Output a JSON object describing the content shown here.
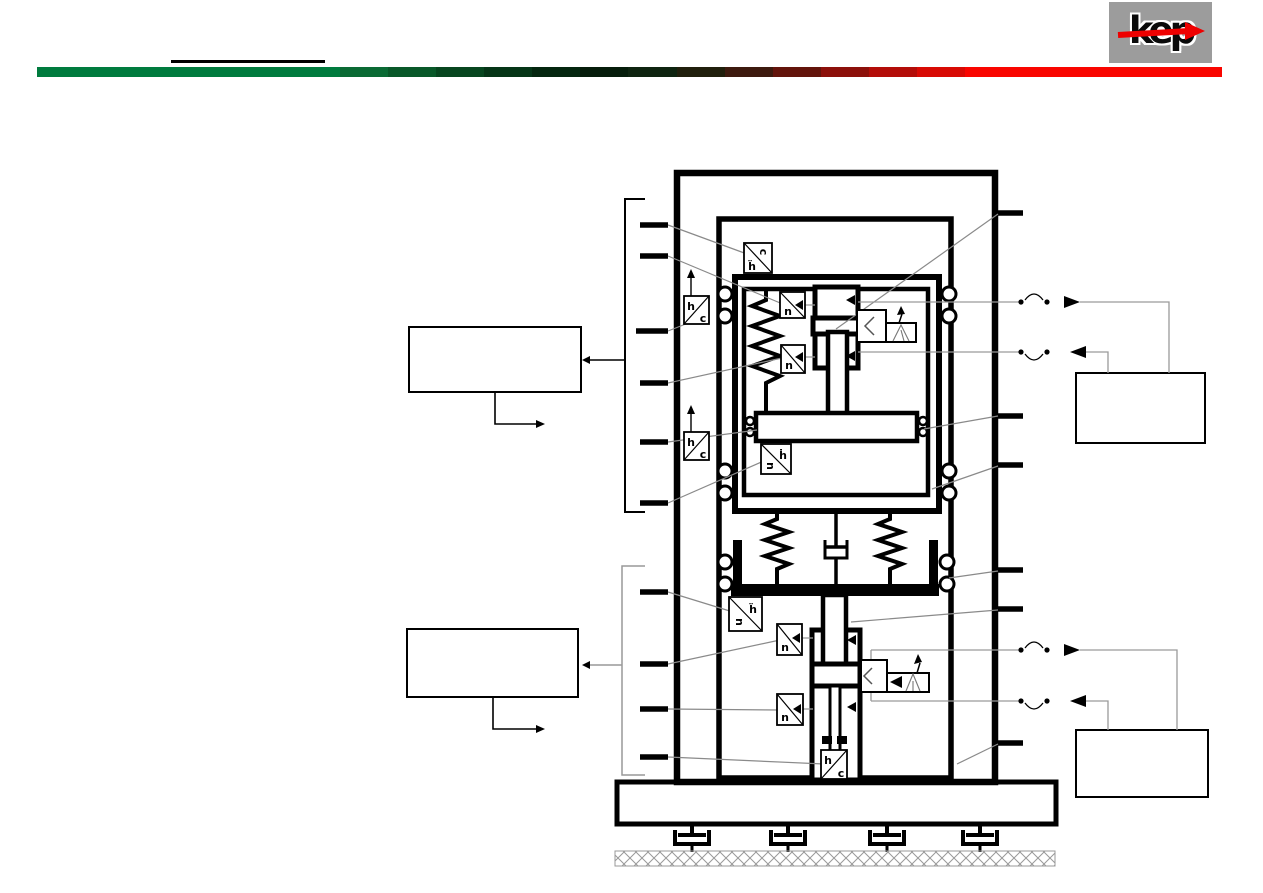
{
  "header": {
    "logo": {
      "text": "kep",
      "bg_color": "#9c9c9c",
      "text_color": "#0a0a0a",
      "arrow_color": "#ee0000"
    },
    "bar": {
      "segments": [
        {
          "w": 303,
          "c": "#007B3E"
        },
        {
          "w": 48,
          "c": "#0A6A34"
        },
        {
          "w": 48,
          "c": "#095829"
        },
        {
          "w": 48,
          "c": "#07461F"
        },
        {
          "w": 48,
          "c": "#053517"
        },
        {
          "w": 48,
          "c": "#04260F"
        },
        {
          "w": 48,
          "c": "#061D0B"
        },
        {
          "w": 49,
          "c": "#0E2410"
        },
        {
          "w": 48,
          "c": "#201F0C"
        },
        {
          "w": 48,
          "c": "#3D1A0E"
        },
        {
          "w": 48,
          "c": "#63140B"
        },
        {
          "w": 48,
          "c": "#8C100A"
        },
        {
          "w": 48,
          "c": "#B30D08"
        },
        {
          "w": 48,
          "c": "#D80A04"
        },
        {
          "w": 257,
          "c": "#F90500"
        }
      ]
    }
  },
  "diagram": {
    "blocks": {
      "car_accel": {
        "a": "ḧ",
        "b": "c"
      },
      "guide_upper": {
        "a": "h",
        "b": "c"
      },
      "rpm_upper_1": {
        "a": "n"
      },
      "rpm_upper_2": {
        "a": "n"
      },
      "platform_vel": {
        "a": "ḣ",
        "b": "u"
      },
      "guide_lower": {
        "a": "h",
        "b": "c"
      },
      "cup_accel": {
        "a": "ḧ",
        "b": "u"
      },
      "rpm_lower_1": {
        "a": "n"
      },
      "rpm_lower_2": {
        "a": "n"
      },
      "bottom_pos": {
        "a": "h",
        "b": "c"
      }
    }
  }
}
